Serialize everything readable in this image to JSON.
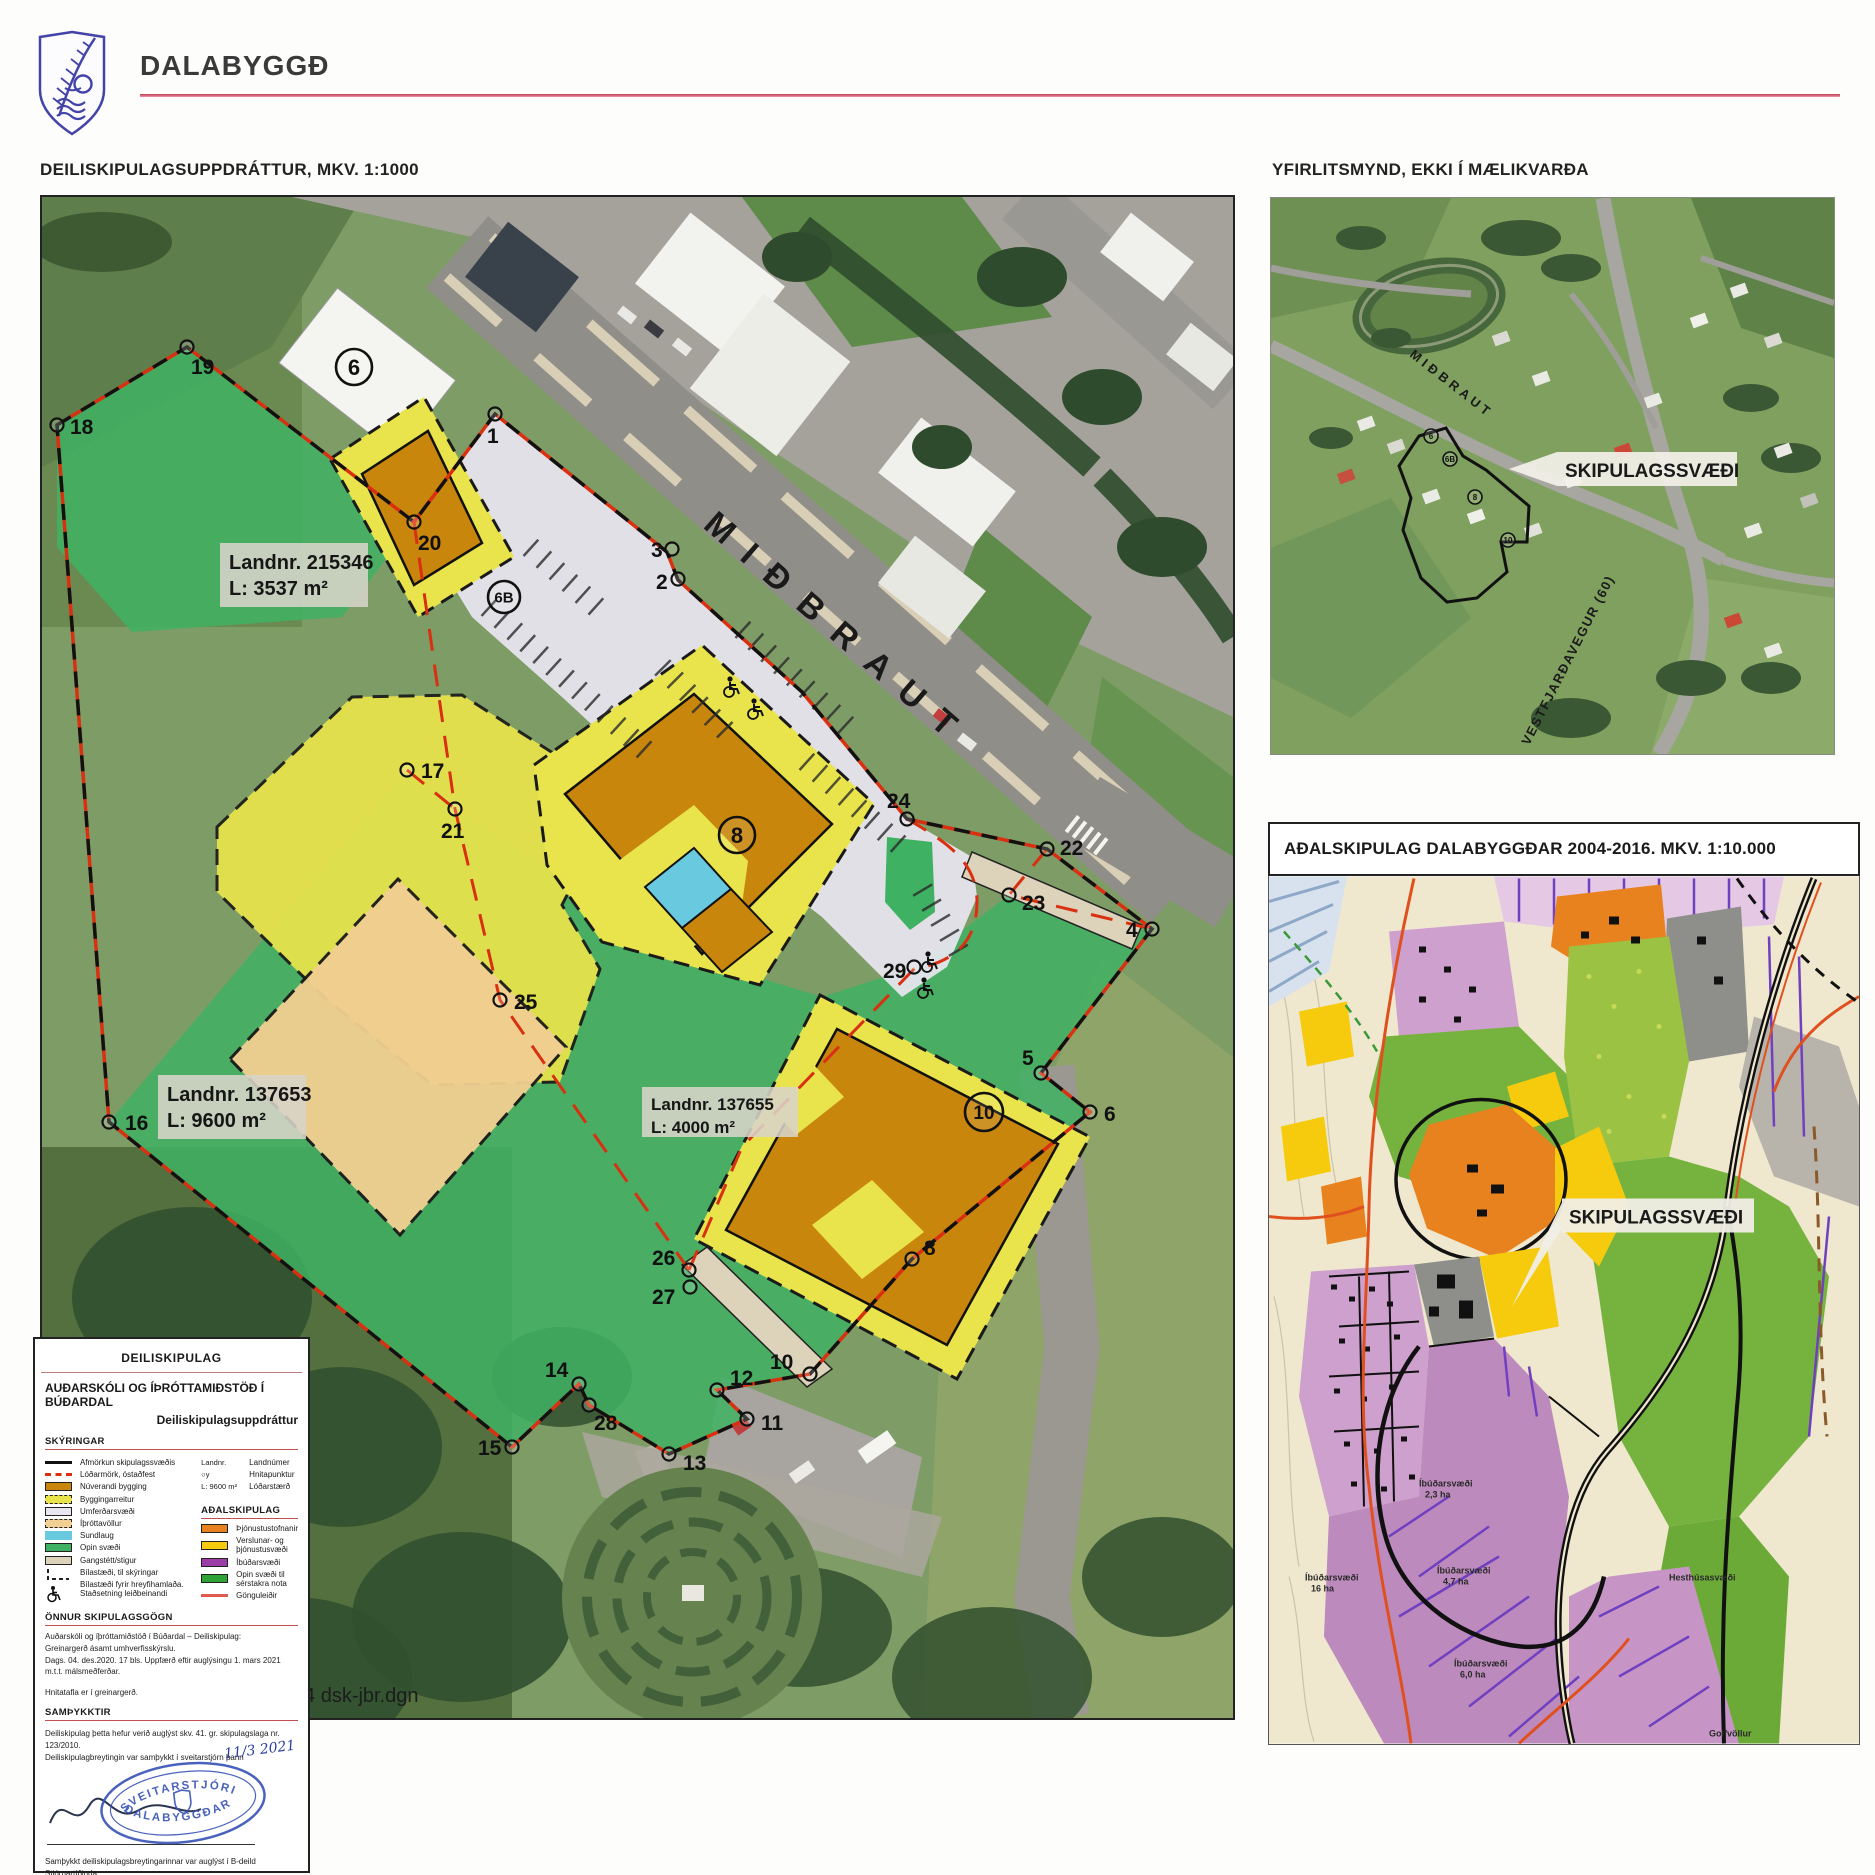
{
  "header": {
    "municipality": "DALABYGGÐ"
  },
  "titles": {
    "main_map": "DEILISKIPULAGSUPPDRÁTTUR, MKV. 1:1000",
    "overview": "YFIRLITSMYND, EKKI Í MÆLIKVARÐA",
    "master_plan": "AÐALSKIPULAG DALABYGGÐAR 2004-2016. MKV. 1:10.000"
  },
  "main_map": {
    "road_label": "MIÐBRAUT",
    "file_ref": "1-004 dsk-jbr.dgn",
    "parcels": [
      {
        "landnr": "Landnr. 215346",
        "area": "L: 3537 m²",
        "x": 178,
        "y": 346,
        "w": 148,
        "h": 64,
        "fs": 20
      },
      {
        "landnr": "Landnr. 137653",
        "area": "L: 9600 m²",
        "x": 116,
        "y": 878,
        "w": 148,
        "h": 64,
        "fs": 20
      },
      {
        "landnr": "Landnr. 137655",
        "area": "L: 4000 m²",
        "x": 600,
        "y": 890,
        "w": 156,
        "h": 50,
        "fs": 17
      }
    ],
    "building_labels": [
      {
        "n": "6",
        "x": 312,
        "y": 170,
        "r": 18,
        "fs": 22
      },
      {
        "n": "6B",
        "x": 462,
        "y": 400,
        "r": 16,
        "fs": 15
      },
      {
        "n": "8",
        "x": 695,
        "y": 638,
        "r": 18,
        "fs": 22
      },
      {
        "n": "10",
        "x": 942,
        "y": 915,
        "r": 19,
        "fs": 19
      }
    ],
    "points": [
      {
        "n": "1",
        "x": 453,
        "y": 217,
        "tx": 445,
        "ty": 246
      },
      {
        "n": "2",
        "x": 636,
        "y": 382,
        "tx": 614,
        "ty": 392
      },
      {
        "n": "3",
        "x": 630,
        "y": 352,
        "tx": 609,
        "ty": 360
      },
      {
        "n": "4",
        "x": 1110,
        "y": 732,
        "tx": 1084,
        "ty": 740
      },
      {
        "n": "5",
        "x": 999,
        "y": 876,
        "tx": 980,
        "ty": 868
      },
      {
        "n": "6",
        "x": 1048,
        "y": 915,
        "tx": 1062,
        "ty": 924
      },
      {
        "n": "8",
        "x": 870,
        "y": 1062,
        "tx": 882,
        "ty": 1058
      },
      {
        "n": "10",
        "x": 768,
        "y": 1177,
        "tx": 728,
        "ty": 1172
      },
      {
        "n": "11",
        "x": 705,
        "y": 1222,
        "tx": 719,
        "ty": 1233
      },
      {
        "n": "12",
        "x": 675,
        "y": 1193,
        "tx": 688,
        "ty": 1188
      },
      {
        "n": "13",
        "x": 627,
        "y": 1257,
        "tx": 641,
        "ty": 1273
      },
      {
        "n": "14",
        "x": 537,
        "y": 1187,
        "tx": 503,
        "ty": 1180
      },
      {
        "n": "15",
        "x": 470,
        "y": 1250,
        "tx": 436,
        "ty": 1258
      },
      {
        "n": "16",
        "x": 67,
        "y": 925,
        "tx": 83,
        "ty": 933
      },
      {
        "n": "17",
        "x": 365,
        "y": 573,
        "tx": 379,
        "ty": 581
      },
      {
        "n": "18",
        "x": 15,
        "y": 228,
        "tx": 28,
        "ty": 237
      },
      {
        "n": "19",
        "x": 145,
        "y": 150,
        "tx": 149,
        "ty": 177
      },
      {
        "n": "20",
        "x": 372,
        "y": 325,
        "tx": 376,
        "ty": 353
      },
      {
        "n": "21",
        "x": 413,
        "y": 612,
        "tx": 399,
        "ty": 641
      },
      {
        "n": "22",
        "x": 1005,
        "y": 652,
        "tx": 1018,
        "ty": 658
      },
      {
        "n": "23",
        "x": 967,
        "y": 698,
        "tx": 980,
        "ty": 713
      },
      {
        "n": "24",
        "x": 865,
        "y": 622,
        "tx": 845,
        "ty": 611
      },
      {
        "n": "25",
        "x": 458,
        "y": 803,
        "tx": 472,
        "ty": 812
      },
      {
        "n": "26",
        "x": 647,
        "y": 1073,
        "tx": 610,
        "ty": 1068
      },
      {
        "n": "27",
        "x": 648,
        "y": 1090,
        "tx": 610,
        "ty": 1107
      },
      {
        "n": "28",
        "x": 547,
        "y": 1208,
        "tx": 552,
        "ty": 1233
      },
      {
        "n": "29",
        "x": 872,
        "y": 770,
        "tx": 841,
        "ty": 781
      }
    ]
  },
  "overview_map": {
    "area_label": "SKIPULAGSSVÆÐI",
    "road1": "MIÐBRAUT",
    "road2": "VESTFJARÐAVEGUR (60)",
    "building_labels": [
      {
        "n": "6",
        "x": 160,
        "y": 238
      },
      {
        "n": "6B",
        "x": 179,
        "y": 261
      },
      {
        "n": "8",
        "x": 204,
        "y": 299
      },
      {
        "n": "10",
        "x": 237,
        "y": 342
      }
    ]
  },
  "master_plan": {
    "area_label": "SKIPULAGSSVÆÐI",
    "area_labels": [
      {
        "line1": "Íbúðarsvæði",
        "line2": "2,3 ha",
        "x": 150,
        "y": 610
      },
      {
        "line1": "Íbúðarsvæði",
        "line2": "4,7 ha",
        "x": 168,
        "y": 697
      },
      {
        "line1": "Íbúðarsvæði",
        "line2": "6,0 ha",
        "x": 185,
        "y": 790
      },
      {
        "line1": "Íbúðarsvæði",
        "line2": "16 ha",
        "x": 36,
        "y": 704
      },
      {
        "line1": "Hesthúsasvæði",
        "line2": "",
        "x": 400,
        "y": 704
      },
      {
        "line1": "Golfvöllur",
        "line2": "",
        "x": 440,
        "y": 860
      }
    ]
  },
  "legend": {
    "doc_type": "DEILISKIPULAG",
    "project_title": "AUÐARSKÓLI OG ÍÞRÓTTAMIÐSTÖÐ Í BÚÐARDAL",
    "subtitle": "Deiliskipulagsuppdráttur",
    "skyringar_heading": "SKÝRINGAR",
    "items": [
      {
        "type": "line",
        "style": "solid",
        "ckey": "line_black",
        "label": "Afmörkun skipulagssvæðis"
      },
      {
        "type": "line",
        "style": "dashed",
        "ckey": "boundary_red",
        "label": "Lóðarmörk, óstaðfest"
      },
      {
        "type": "box",
        "ckey": "bygging",
        "border": "solid",
        "label": "Núverandi bygging"
      },
      {
        "type": "box",
        "ckey": "byggingarreitur",
        "border": "dashed",
        "label": "Byggingarreitur"
      },
      {
        "type": "box",
        "ckey": "umferdarsvaedi",
        "border": "solid",
        "label": "Umferðarsvæði"
      },
      {
        "type": "box",
        "ckey": "ithrottavollur",
        "border": "dashed",
        "label": "Íþróttavöllur"
      },
      {
        "type": "box",
        "ckey": "sundlaug",
        "border": "none",
        "label": "Sundlaug"
      },
      {
        "type": "box",
        "ckey": "opin_svaedi",
        "border": "solid",
        "label": "Opin svæði"
      },
      {
        "type": "box",
        "ckey": "gangstett",
        "border": "solid",
        "label": "Gangstétt/stigur"
      },
      {
        "type": "icon-parking",
        "label": "Bílastæði, til skýringar"
      },
      {
        "type": "icon-wheelchair",
        "label": "Bílastæði fyrir hreyfihamlaða. Staðsetning leiðbeinandi"
      }
    ],
    "symbol_rows": [
      {
        "symbol": "Landnr.",
        "label": "Landnúmer"
      },
      {
        "symbol": "○y",
        "label": "Hnitapunktur"
      },
      {
        "symbol": "L: 9600 m²",
        "label": "Lóðarstærð"
      }
    ],
    "adalskipulag_heading": "AÐALSKIPULAG",
    "adalskipulag_items": [
      {
        "type": "box",
        "ckey": "adal_thjonustustofnanir",
        "border": "solid",
        "label": "Þjónustustofnanir"
      },
      {
        "type": "box",
        "ckey": "adal_verslun_thjonusta",
        "border": "solid",
        "label": "Verslunar- og þjónustusvæði"
      },
      {
        "type": "box",
        "ckey": "adal_ibudarsvaedi",
        "border": "solid",
        "label": "Íbúðarsvæði"
      },
      {
        "type": "box",
        "ckey": "adal_opin_serstok",
        "border": "solid",
        "label": "Opin svæði til sérstakra nota"
      },
      {
        "type": "line",
        "style": "solid",
        "ckey": "adal_gonguleidir",
        "label": "Gönguleiðir"
      }
    ],
    "onnur_heading": "ÖNNUR SKIPULAGSGÖGN",
    "onnur_lines": [
      "Auðarskóli og íþróttamiðstöð í Búðardal  – Deiliskipulag:",
      "Greinargerð ásamt umhverfisskýrslu.",
      "Dags. 04. des.2020. 17 bls. Uppfærð eftir auglýsingu 1. mars 2021",
      "m.t.t. málsmeðferðar."
    ],
    "hnitatafla_note": "Hnitatafla er í greinargerð.",
    "samthykktir_heading": "SAMÞYKKTIR",
    "approval_line1": "Deiliskipulag þetta hefur verið auglýst skv. 41. gr. skipulagslaga nr. 123/2010.",
    "approval_line2": "Deiliskipulagbreytingin var samþykkt í sveitarstjórn þann",
    "approval_date": "11/3 2021",
    "stamp_top": "SVEITARSTJÓRI",
    "stamp_bottom": "DALABYGGÐAR",
    "publication_line": "Samþykkt deiliskipulagsbreytingarinnar var auglýst í B-deild Stjórnartíðinda",
    "publication_word": "þann",
    "publication_date": "23/7 2021",
    "faint_stamp": "Skipulagsstofnun"
  },
  "colors": {
    "line_black": "#111111",
    "boundary_red": "#d83010",
    "bygging": "#c8860d",
    "byggingarreitur": "#eae44c",
    "umferdarsvaedi": "#e9e6f1",
    "ithrottavollur": "#f2cf92",
    "sundlaug": "#69c9de",
    "opin_svaedi": "#3fb163",
    "gangstett": "#dcd3ba",
    "adal_thjonustustofnanir": "#e8821e",
    "adal_verslun_thjonusta": "#f6cb0e",
    "adal_ibudarsvaedi": "#9d3da8",
    "adal_opin_serstok": "#2fa335",
    "adal_gonguleidir": "#e05a50",
    "stamp_blue": "#3a55b8",
    "header_rule": "#c43a50"
  }
}
